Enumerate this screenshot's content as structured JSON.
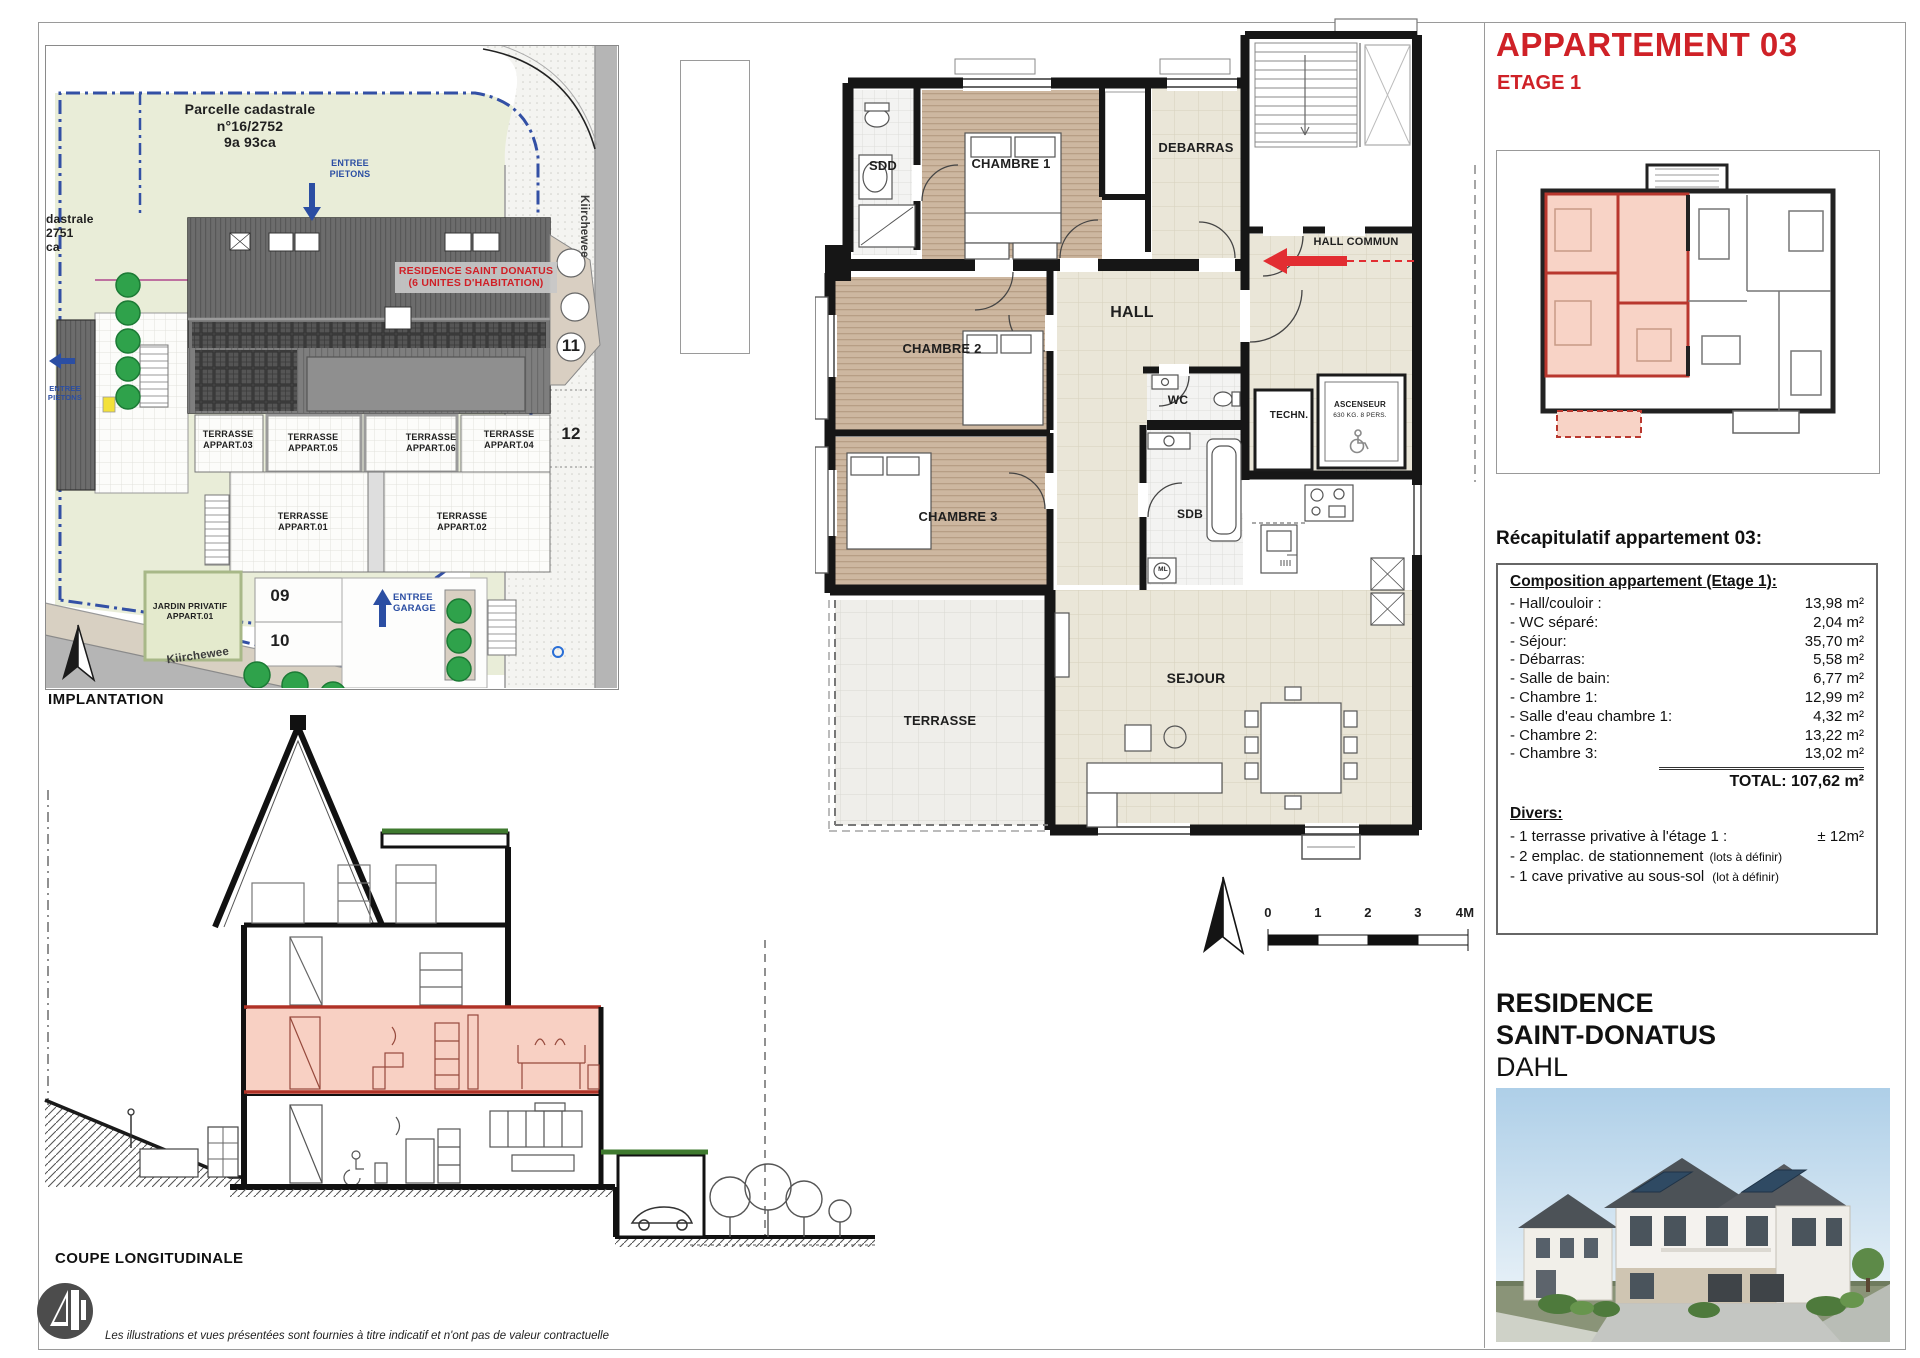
{
  "header": {
    "title": "APPARTEMENT 03",
    "floor": "ETAGE 1"
  },
  "site_plan": {
    "caption": "IMPLANTATION",
    "parcel_label": "Parcelle cadastrale\nn°16/2752\n9a 93ca",
    "parcel_label_left": "dastrale\n2751\nca",
    "building_label": "RESIDENCE SAINT DONATUS\n(6 UNITES D'HABITATION)",
    "street_name_vertical": "Kiirchewee",
    "street_name_bottom": "Kiirchewee",
    "entrance_pedestrian": "ENTREE\nPIETONS",
    "entrance_pedestrian_left": "ENTREE\nPIETONS",
    "entrance_garage": "ENTREE\nGARAGE",
    "garden_label": "JARDIN PRIVATIF\nAPPART.01",
    "terraces": [
      {
        "label": "TERRASSE\nAPPART.03"
      },
      {
        "label": "TERRASSE\nAPPART.05"
      },
      {
        "label": "TERRASSE\nAPPART.06"
      },
      {
        "label": "TERRASSE\nAPPART.04"
      },
      {
        "label": "TERRASSE\nAPPART.01"
      },
      {
        "label": "TERRASSE\nAPPART.02"
      }
    ],
    "parking_spots": [
      "09",
      "10",
      "11",
      "12"
    ]
  },
  "floor_plan": {
    "rooms": {
      "sdd": "SDD",
      "chambre1": "CHAMBRE 1",
      "debarras": "DEBARRAS",
      "chambre2": "CHAMBRE 2",
      "hall": "HALL",
      "hall_commun": "HALL COMMUN",
      "wc": "WC",
      "techn": "TECHN.",
      "ascenseur": "ASCENSEUR",
      "ascenseur_capacity": "630 KG. 8 PERS.",
      "chambre3": "CHAMBRE 3",
      "sdb": "SDB",
      "ml": "ML",
      "sejour": "SEJOUR",
      "terrasse": "TERRASSE"
    },
    "scale_bar": {
      "ticks": [
        "0",
        "1",
        "2",
        "3",
        "4M"
      ]
    }
  },
  "section": {
    "caption": "COUPE LONGITUDINALE"
  },
  "recap": {
    "heading": "Récapitulatif appartement 03:",
    "composition_title": "Composition appartement (Etage 1):",
    "items": [
      {
        "label": "- Hall/couloir :",
        "value": "13,98 m²"
      },
      {
        "label": "- WC séparé:",
        "value": "2,04 m²"
      },
      {
        "label": "- Séjour:",
        "value": "35,70 m²"
      },
      {
        "label": "- Débarras:",
        "value": "5,58 m²"
      },
      {
        "label": "- Salle de bain:",
        "value": "6,77 m²"
      },
      {
        "label": "- Chambre 1:",
        "value": "12,99 m²"
      },
      {
        "label": "- Salle d'eau chambre 1:",
        "value": "4,32 m²"
      },
      {
        "label": "- Chambre 2:",
        "value": "13,22 m²"
      },
      {
        "label": "- Chambre 3:",
        "value": "13,02 m²"
      }
    ],
    "total": "TOTAL: 107,62 m²",
    "divers_title": "Divers:",
    "divers": [
      {
        "label": "- 1 terrasse privative à l'étage 1 :",
        "value": "± 12m²"
      },
      {
        "label": "- 2 emplac. de stationnement",
        "note": "(lots à définir)"
      },
      {
        "label": "- 1 cave privative au sous-sol",
        "note": "(lot à définir)"
      }
    ]
  },
  "branding": {
    "residence_line1": "RESIDENCE",
    "residence_line2": "SAINT-DONATUS",
    "residence_line3": "DAHL"
  },
  "footer": {
    "disclaimer": "Les illustrations et vues présentées sont fournies à titre indicatif et n'ont pas de valeur contractuelle"
  },
  "colors": {
    "accent_red": "#cf2127",
    "plan_blue": "#2b4ea3",
    "tree_green": "#2fa24b",
    "parcel_green": "#e9edd8",
    "wood": "#cdb7a0",
    "tile_beige": "#eae6d8",
    "highlight_pink": "#f7d0c4",
    "street_gray": "#b5b5b5"
  }
}
